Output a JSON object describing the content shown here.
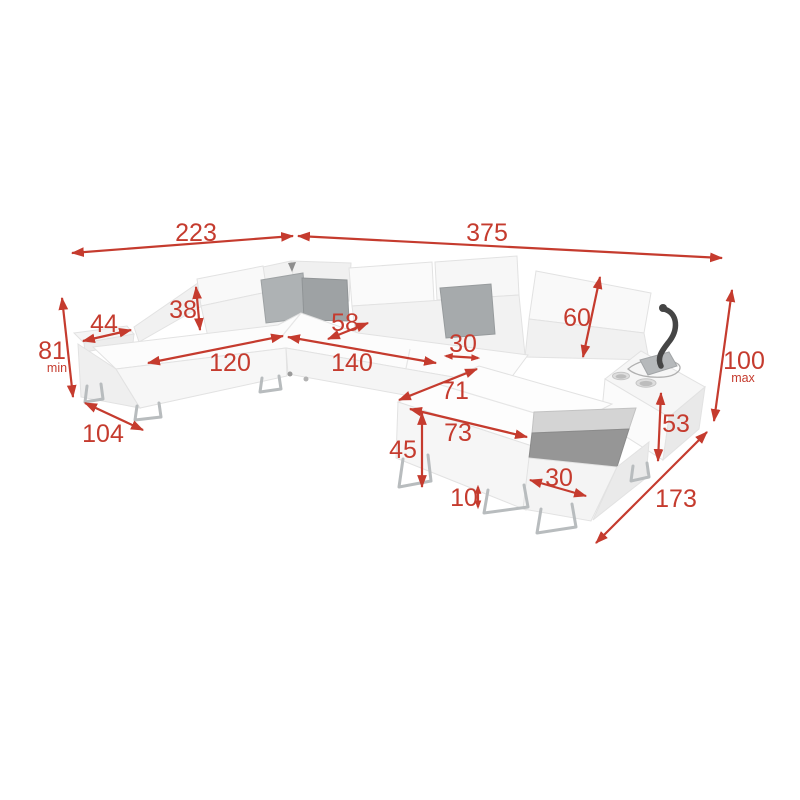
{
  "page": {
    "background": "#ffffff"
  },
  "diagram": {
    "type": "furniture-dimension-diagram",
    "subject": "U-shaped corner sofa with storage and cup-holder armrest",
    "colors": {
      "accent": "#c53b2e",
      "upholstery": "#f8f8f8",
      "pillow": "#a6aaac",
      "metal": "#b8bcbe",
      "storage": "#969696",
      "accessory": "#454545"
    },
    "dimensions": {
      "back_width_left": {
        "value": "223"
      },
      "back_width_right": {
        "value": "375"
      },
      "height_min": {
        "value": "81",
        "suffix": "min"
      },
      "armrest_width": {
        "value": "44"
      },
      "headrest_height": {
        "value": "38"
      },
      "chaise_seat_length": {
        "value": "120"
      },
      "chaise_width": {
        "value": "104"
      },
      "corner_seat_width": {
        "value": "58"
      },
      "middle_seat_length": {
        "value": "140"
      },
      "seat_section_width": {
        "value": "30"
      },
      "backrest_height": {
        "value": "60"
      },
      "height_max": {
        "value": "100",
        "suffix": "max"
      },
      "armrest_height": {
        "value": "53"
      },
      "right_side_depth": {
        "value": "173"
      },
      "bed_section_width": {
        "value": "71"
      },
      "bed_section_length": {
        "value": "73"
      },
      "base_height": {
        "value": "45"
      },
      "leg_height": {
        "value": "10"
      },
      "storage_width": {
        "value": "30"
      }
    }
  }
}
